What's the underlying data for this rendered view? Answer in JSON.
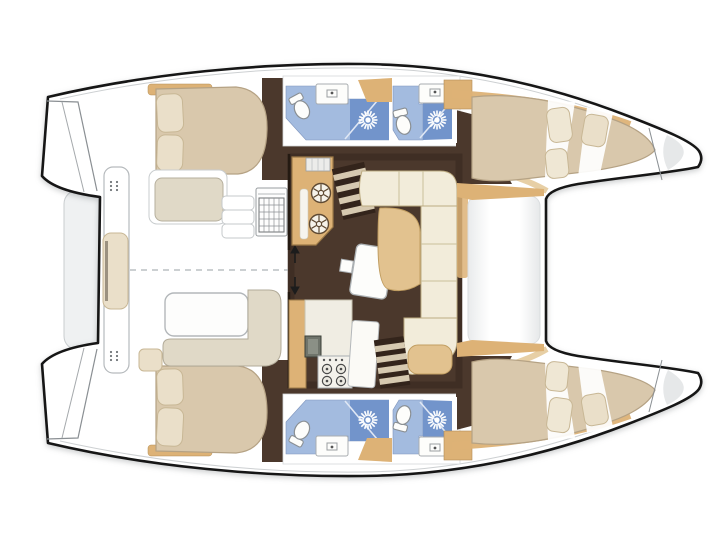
{
  "meta": {
    "view": "top-down interior floor plan",
    "subject": "catamaran sailing yacht, four-cabin layout, bows to the right"
  },
  "colors": {
    "outline": "#161616",
    "hull": "#ffffff",
    "floor": "#4b382c",
    "floor_dark": "#33241b",
    "wood": "#ddb276",
    "wood_light": "#e7cfa5",
    "bed": "#d9c8ac",
    "pillow": "#eadfc9",
    "pillow_light": "#efe7d4",
    "cushion": "#e2c28f",
    "sofa": "#f2ecda",
    "greige": "#e0d9c7",
    "bath_floor": "#a3bbdf",
    "shower_floor": "#7294cb",
    "fixture": "#fdfdfb",
    "platform": "#eff1f2",
    "step_band": "#d6c9b0"
  },
  "layout": {
    "orientation": "bows-right, sterns-left",
    "hulls": [
      {
        "side": "port (top)",
        "rooms": [
          "transom steps",
          "aft double cabin with island bed and two pillows",
          "aft head: toilet, sink, shower",
          "forward head: toilet, sink, shower",
          "forward double cabin with bed and pillows",
          "anchor locker in bow tip"
        ]
      },
      {
        "side": "starboard (bottom)",
        "rooms": [
          "transom steps",
          "aft double cabin with island bed and two pillows",
          "aft head: toilet, sink, shower",
          "forward head: toilet, sink, shower",
          "forward double cabin with bed and pillows",
          "anchor locker in bow tip"
        ]
      }
    ],
    "bridgedeck": {
      "aft_cockpit": [
        "transverse aft bench with center cushion",
        "side bench seat",
        "boarding steps",
        "fridge / grill module",
        "cockpit table",
        "L-shaped bench",
        "small corner cushion",
        "sliding-door arrows",
        "dashed centerline"
      ],
      "saloon": [
        "aft galley counter with twin burners and sink appliance",
        "companionway stairs to port hull",
        "tilted saloon table with support block",
        "U-shaped sofa with seat divisions",
        "tan chaise cushion",
        "tan nav cabinet",
        "forward galley block: cabinet, oven, 4-burner stove, tilted counter",
        "companionway stairs to starboard hull"
      ],
      "forward_cockpit": [
        "white lounging deck between windshield and saloon",
        "tan side-deck wedges"
      ]
    },
    "symbols": {
      "shower": "white starburst on dark blue pan",
      "toilet": "white oval pan with cistern",
      "burner": "circle with spokes (large) or ringed dot (small)"
    }
  },
  "counts": {
    "cabins": 4,
    "heads": 4,
    "toilets": 4,
    "shower_starbursts": 4,
    "aux_burners": 2,
    "stove_burners": 4,
    "staircases": 2
  }
}
